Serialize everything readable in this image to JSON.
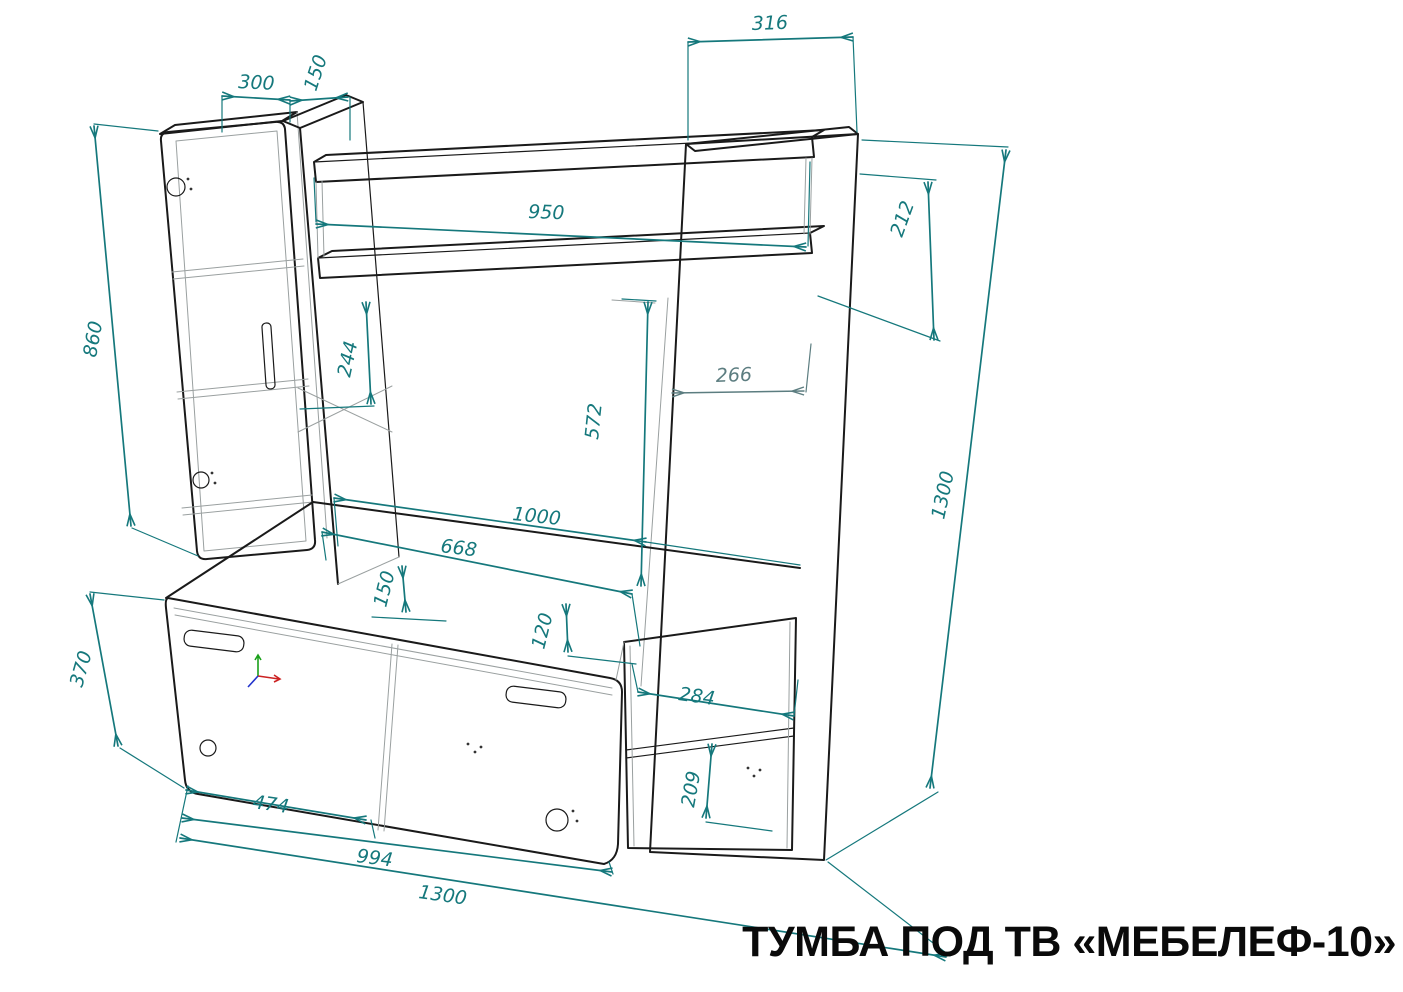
{
  "title": "ТУМБА ПОД ТВ «МЕБЕЛЕФ-10»",
  "colors": {
    "dimension_lines": "#15787c",
    "dimension_gray": "#5c7d80",
    "drawing_lines": "#1a1a1a",
    "secondary_lines": "#9aa0a0",
    "title_text": "#0a0a0a",
    "axis_x_red": "#cc2222",
    "axis_y_green": "#1aa01a",
    "axis_z_blue": "#2233cc"
  },
  "dims": {
    "top_left_width": "300",
    "top_left_depth": "150",
    "top_right_depth": "316",
    "shelf_offset_right": "212",
    "total_height_right": "1300",
    "left_cabinet_height": "860",
    "top_shelf_length": "950",
    "shelf_gap_left": "244",
    "niche_height": "572",
    "shelf_depth": "266",
    "niche_width": "1000",
    "base_inner_width": "668",
    "base_left_gap": "150",
    "base_shelf_gap": "120",
    "base_height": "370",
    "open_section_width": "284",
    "open_section_height": "209",
    "left_door_width": "474",
    "base_front_width": "994",
    "total_width": "1300"
  },
  "icons": {
    "ucs_axis": "coordinate-origin-axes"
  }
}
